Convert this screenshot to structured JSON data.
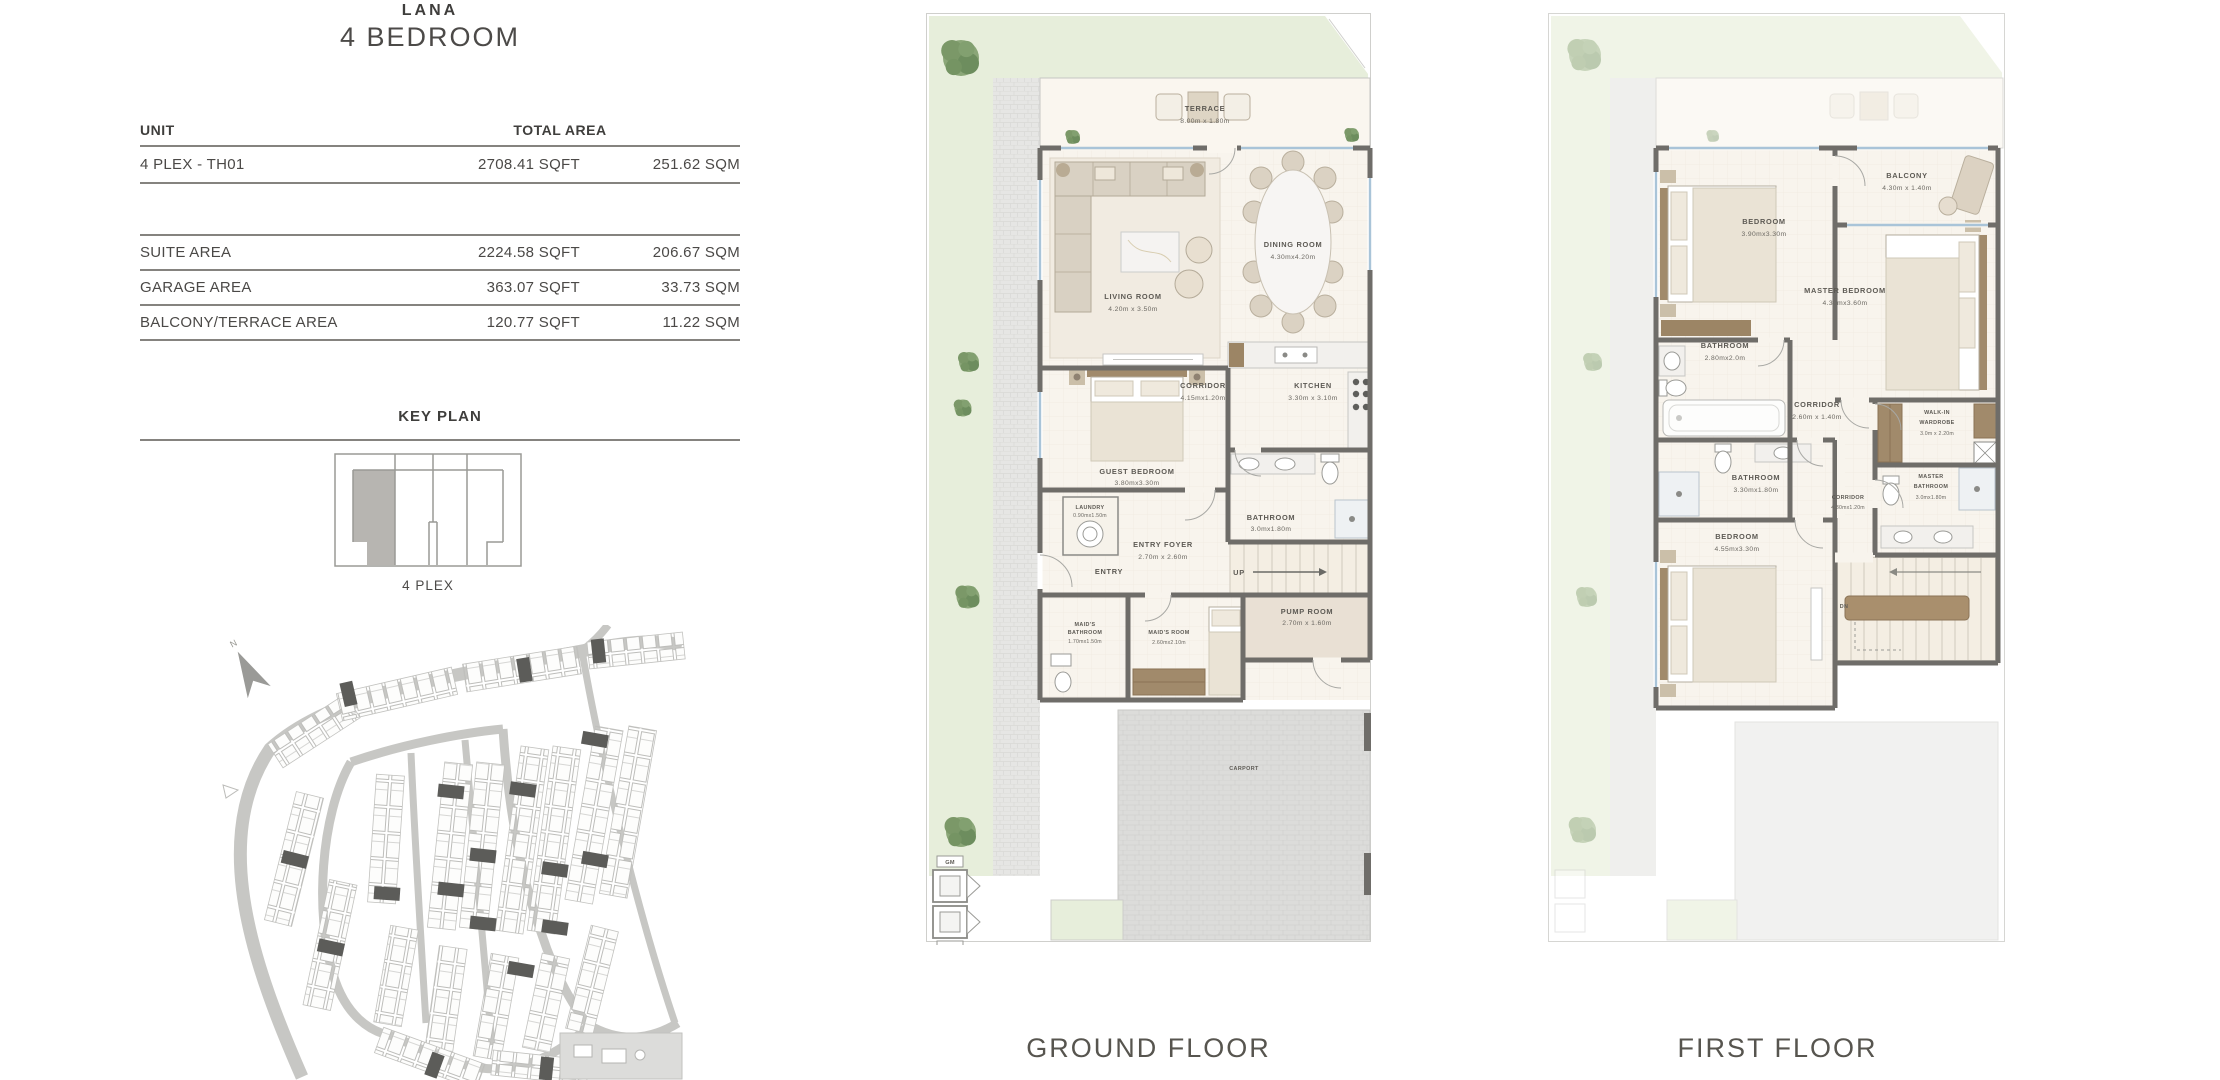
{
  "header": {
    "project": "LANA",
    "type": "4 BEDROOM"
  },
  "table": {
    "unit_header": "UNIT",
    "total_area_header": "TOTAL AREA",
    "unit_row": {
      "name": "4 PLEX - TH01",
      "sqft": "2708.41  SQFT",
      "sqm": "251.62  SQM"
    },
    "area_rows": [
      {
        "label": "SUITE AREA",
        "sqft": "2224.58  SQFT",
        "sqm": "206.67  SQM"
      },
      {
        "label": "GARAGE AREA",
        "sqft": "363.07  SQFT",
        "sqm": "33.73  SQM"
      },
      {
        "label": "BALCONY/TERRACE AREA",
        "sqft": "120.77  SQFT",
        "sqm": "11.22  SQM"
      }
    ]
  },
  "key_plan": {
    "title": "KEY PLAN",
    "caption": "4 PLEX"
  },
  "site_map": {
    "north_label": "N"
  },
  "ground": {
    "caption": "GROUND FLOOR",
    "rooms": {
      "terrace": {
        "name": "TERRACE",
        "dims": "8.00m x 1.80m"
      },
      "living": {
        "name": "LIVING ROOM",
        "dims": "4.20m x 3.50m"
      },
      "dining": {
        "name": "DINING ROOM",
        "dims": "4.30mx4.20m"
      },
      "corridor": {
        "name": "CORRIDOR",
        "dims": "4.15mx1.20m"
      },
      "kitchen": {
        "name": "KITCHEN",
        "dims": "3.30m x 3.10m"
      },
      "guest_bedroom": {
        "name": "GUEST BEDROOM",
        "dims": "3.80mx3.30m"
      },
      "bathroom": {
        "name": "BATHROOM",
        "dims": "3.0mx1.80m"
      },
      "laundry": {
        "name": "LAUNDRY",
        "dims": "0.90mx1.50m"
      },
      "entry_foyer": {
        "name": "ENTRY FOYER",
        "dims": "2.70m x 2.60m"
      },
      "entry": {
        "name": "ENTRY"
      },
      "stairs": {
        "name": "UP"
      },
      "maids_bathroom": {
        "line1": "MAID'S",
        "line2": "BATHROOM",
        "dims": "1.70mx1.50m"
      },
      "maids_room": {
        "name": "MAID'S ROOM",
        "dims": "2.60mx2.10m"
      },
      "pump_room": {
        "name": "PUMP ROOM",
        "dims": "2.70m x 1.60m"
      },
      "carport": {
        "name": "CARPORT"
      },
      "gas_meter": "GM",
      "water_meter": "WM"
    }
  },
  "first": {
    "caption": "FIRST FLOOR",
    "rooms": {
      "balcony": {
        "name": "BALCONY",
        "dims": "4.30m x 1.40m"
      },
      "bedroom_2": {
        "name": "BEDROOM",
        "dims": "3.90mx3.30m"
      },
      "master_bedroom": {
        "name": "MASTER BEDROOM",
        "dims": "4.30mx3.60m"
      },
      "bathroom_2": {
        "name": "BATHROOM",
        "dims": "2.80mx2.0m"
      },
      "corridor_1": {
        "name": "CORRIDOR",
        "dims": "2.60m x 1.40m"
      },
      "walk_in_wardrobe": {
        "line1": "WALK-IN",
        "line2": "WARDROBE",
        "dims": "3.0m x 2.20m"
      },
      "bathroom_3": {
        "name": "BATHROOM",
        "dims": "3.30mx1.80m"
      },
      "corridor_2": {
        "name": "CORRIDOR",
        "dims": "4.30mx1.20m"
      },
      "master_bathroom": {
        "line1": "MASTER",
        "line2": "BATHROOM",
        "dims": "3.0mx1.80m"
      },
      "bedroom_3": {
        "name": "BEDROOM",
        "dims": "4.55mx3.30m"
      },
      "stairs": {
        "name": "DN"
      }
    }
  },
  "colors": {
    "wall": "#6f6d69",
    "floor": "#f8f4ed",
    "garden": "#e7eedb",
    "paving": "#e3e3e1",
    "carport": "#dbdbd9",
    "wood": "#a18a6b",
    "window": "#a9c4d8",
    "text": "#5d5a54",
    "tree": "#7d9a6d",
    "key_highlight": "#b7b5b1",
    "line": "#85837f"
  }
}
